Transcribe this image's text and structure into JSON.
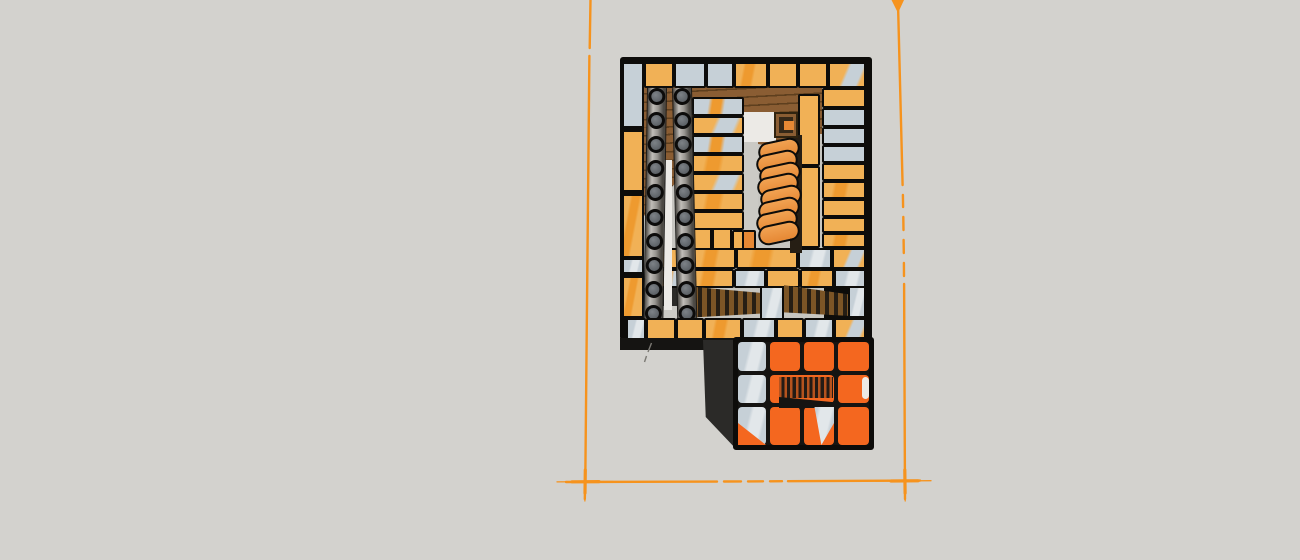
{
  "scene": {
    "kind": "3d-model-viewport",
    "subject": "masonry-heater-brick-course-top-view",
    "tube_knob_rows": 10,
    "tube_columns": 2,
    "orange_stack_brick_count": 8
  },
  "colors": {
    "bg": "#d3d2ce",
    "outline": "#0d0c0a",
    "yellow": "#f1b156",
    "yellowOrange": "#ee9a2f",
    "gray": "#c6d0d7",
    "grayLight": "#e2e7ea",
    "floor": "#c7c6c1",
    "offwhite": "#eceae6",
    "lightStrip": "#cbcac5",
    "wood": "#8a5d33",
    "woodLine": "#5e3f1e",
    "slat": "#7c5526",
    "slatBg": "#261e14",
    "shadow": "#2b2a28",
    "nearBlack": "#151412",
    "fire": "#f4671f",
    "knob": "#5c6166",
    "knobHi": "#7d8287",
    "tubeHi": "#c0bdb8",
    "tubeMid": "#989590",
    "tubeLo": "#4c4944",
    "guide": "#f6931d",
    "stackHi": "#f1a252",
    "stackLo": "#e68834",
    "pencil": "#7b7973"
  },
  "model": {
    "main_block": [
      620,
      57,
      252,
      283
    ],
    "fills1": [
      [
        644,
        86,
        180,
        234,
        "floor"
      ],
      [
        644,
        86,
        178,
        48,
        "wood"
      ],
      [
        698,
        128,
        122,
        30,
        "wood",
        "cp-wedge"
      ],
      [
        644,
        128,
        58,
        110,
        "wood",
        "cp-wtubes"
      ],
      [
        686,
        130,
        8,
        172,
        "wood"
      ],
      [
        742,
        112,
        34,
        30,
        "offwhite"
      ],
      [
        744,
        142,
        14,
        92,
        "lightStrip"
      ]
    ],
    "bricks1": [
      [
        644,
        62,
        30,
        26,
        "yellow"
      ],
      [
        674,
        62,
        32,
        26,
        "gray"
      ],
      [
        706,
        62,
        28,
        26,
        "gray"
      ],
      [
        734,
        62,
        34,
        26,
        "yellowStreak"
      ],
      [
        768,
        62,
        30,
        26,
        "yellow"
      ],
      [
        798,
        62,
        30,
        26,
        "yellow"
      ],
      [
        828,
        62,
        38,
        26,
        "yellowGray"
      ],
      [
        622,
        62,
        22,
        66,
        "gray"
      ],
      [
        622,
        130,
        22,
        62,
        "yellow"
      ],
      [
        622,
        194,
        22,
        64,
        "yellowStreak"
      ],
      [
        622,
        258,
        22,
        16,
        "grayWhite"
      ],
      [
        622,
        276,
        22,
        42,
        "yellowStreak"
      ],
      [
        822,
        88,
        44,
        20,
        "yellow"
      ],
      [
        822,
        108,
        44,
        19,
        "gray"
      ],
      [
        822,
        127,
        44,
        18,
        "gray"
      ],
      [
        822,
        145,
        44,
        18,
        "gray"
      ],
      [
        822,
        163,
        44,
        18,
        "yellow"
      ],
      [
        822,
        181,
        44,
        18,
        "yellowStreak"
      ],
      [
        822,
        199,
        44,
        18,
        "yellow"
      ],
      [
        822,
        217,
        44,
        16,
        "yellow"
      ],
      [
        822,
        233,
        44,
        15,
        "yellowStreak"
      ],
      [
        692,
        97,
        52,
        19,
        "grayStreak"
      ],
      [
        692,
        116,
        52,
        19,
        "yellowGray"
      ],
      [
        692,
        135,
        52,
        19,
        "grayStreak"
      ],
      [
        692,
        154,
        52,
        19,
        "yellowStreak"
      ],
      [
        692,
        173,
        52,
        19,
        "yellowGray"
      ],
      [
        692,
        192,
        52,
        19,
        "yellowStreak"
      ],
      [
        692,
        211,
        52,
        19,
        "yellow"
      ],
      [
        690,
        228,
        22,
        22,
        "yellow"
      ],
      [
        712,
        228,
        20,
        22,
        "yellow"
      ],
      [
        732,
        230,
        12,
        20,
        "yellow"
      ],
      [
        742,
        230,
        14,
        20,
        "orangeSmall"
      ],
      [
        798,
        94,
        22,
        72,
        "yellow"
      ],
      [
        798,
        166,
        22,
        82,
        "yellow"
      ],
      [
        646,
        248,
        46,
        21,
        "yellow"
      ],
      [
        692,
        248,
        44,
        21,
        "yellowStreak"
      ],
      [
        736,
        248,
        62,
        21,
        "yellowStreak"
      ],
      [
        798,
        248,
        34,
        21,
        "grayWhite"
      ],
      [
        832,
        248,
        34,
        21,
        "yellowGray"
      ],
      [
        646,
        269,
        44,
        19,
        "grayStreak"
      ],
      [
        690,
        269,
        44,
        19,
        "yellowStreak"
      ],
      [
        734,
        269,
        32,
        19,
        "grayWhite"
      ],
      [
        766,
        269,
        34,
        19,
        "yellow"
      ],
      [
        800,
        269,
        34,
        19,
        "yellowStreak"
      ],
      [
        834,
        269,
        32,
        19,
        "grayWhite"
      ]
    ],
    "mid_fills": [
      [
        790,
        135,
        12,
        118,
        "slatBg"
      ]
    ],
    "post": [
      774,
      112,
      24,
      26
    ],
    "stack": {
      "x": 756,
      "y": 140,
      "w": 42,
      "h": 20,
      "count": 8,
      "step": 11.8,
      "rot": -12,
      "jitter": [
        2,
        0,
        3,
        1,
        4,
        2,
        0,
        2
      ]
    },
    "fills2": [
      [
        644,
        288,
        42,
        30,
        "shadow"
      ],
      [
        684,
        286,
        78,
        32,
        "slats",
        "cp-slatL"
      ],
      [
        784,
        283,
        64,
        35,
        "slats",
        "cp-slatR"
      ],
      [
        646,
        306,
        50,
        13,
        "lightStrip"
      ],
      [
        664,
        160,
        8,
        150,
        "offwhite"
      ]
    ],
    "tubes": {
      "w": 20,
      "h": 246,
      "y": 88,
      "knob_count": 10,
      "knob_step": 24.2,
      "knob_first": 8,
      "columns": [
        {
          "x": 647,
          "rot": 0.9
        },
        {
          "x": 672,
          "rot": -1.3
        }
      ]
    },
    "bricks2": [
      [
        760,
        286,
        24,
        34,
        "grayWhite"
      ],
      [
        848,
        286,
        18,
        32,
        "grayWhite"
      ],
      [
        626,
        318,
        20,
        26,
        "grayWhite"
      ],
      [
        646,
        318,
        30,
        26,
        "yellow"
      ],
      [
        676,
        318,
        28,
        26,
        "yellow"
      ],
      [
        704,
        318,
        38,
        26,
        "yellowStreak"
      ],
      [
        742,
        318,
        34,
        26,
        "grayWhite"
      ],
      [
        776,
        318,
        28,
        26,
        "yellow"
      ],
      [
        804,
        318,
        30,
        26,
        "grayWhite"
      ],
      [
        834,
        318,
        32,
        26,
        "yellowGray"
      ]
    ],
    "firebox": {
      "under_strip": [
        620,
        338,
        116,
        12,
        "nearBlack"
      ],
      "side_panel": [
        703,
        340,
        34,
        110,
        "shadow",
        "cp-side"
      ],
      "face": [
        733,
        337,
        141,
        113
      ],
      "cells": [
        [
          738,
          342,
          28,
          29,
          "grayWhite"
        ],
        [
          770,
          342,
          30,
          29,
          "fire"
        ],
        [
          804,
          342,
          30,
          29,
          "fire"
        ],
        [
          838,
          342,
          31,
          29,
          "fire"
        ],
        [
          738,
          375,
          28,
          28,
          "grayWhite"
        ],
        [
          770,
          375,
          64,
          28,
          "fire"
        ],
        [
          838,
          375,
          31,
          28,
          "fire"
        ],
        [
          738,
          407,
          28,
          38,
          "grayWhite"
        ],
        [
          770,
          407,
          30,
          38,
          "fire"
        ],
        [
          804,
          407,
          30,
          38,
          "fire"
        ],
        [
          838,
          407,
          31,
          38,
          "fire"
        ]
      ],
      "opening": [
        779,
        377,
        54,
        21,
        "stripes"
      ],
      "opening_floor": [
        779,
        395,
        54,
        13,
        "nearBlack",
        "cp-owedge"
      ],
      "overlays": [
        [
          738,
          407,
          28,
          38,
          "fire",
          "cp-tri"
        ],
        [
          804,
          407,
          30,
          38,
          "grayWhite",
          "cp-gwedge"
        ],
        [
          862,
          377,
          7,
          22,
          "offwhite",
          "rounded"
        ]
      ]
    }
  }
}
